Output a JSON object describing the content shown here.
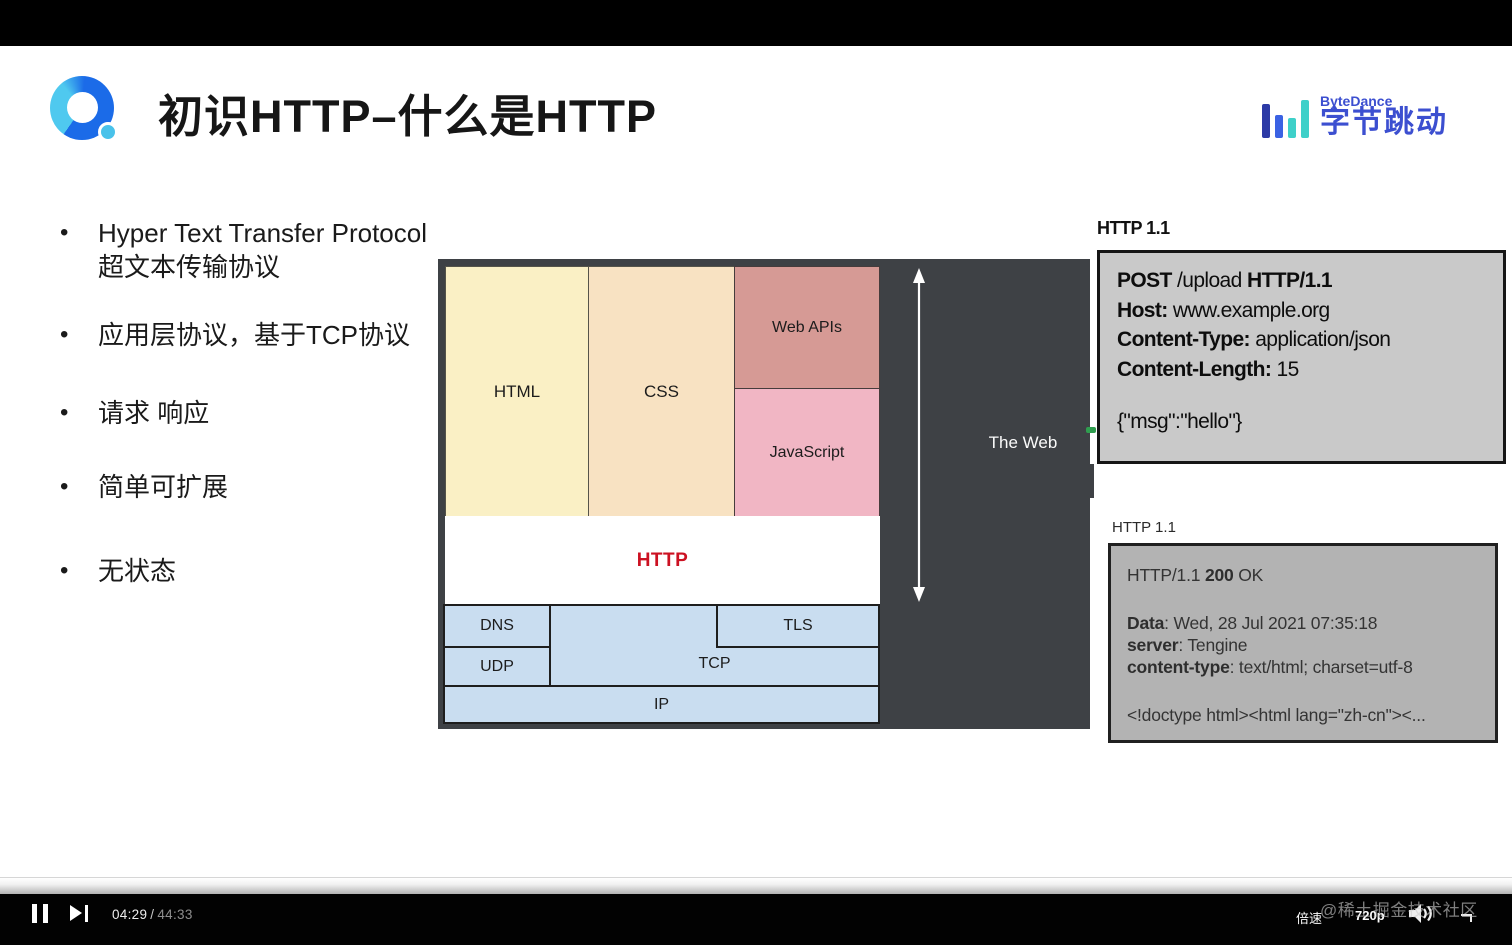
{
  "player": {
    "current_time": "04:29",
    "time_separator": "/",
    "duration": "44:33",
    "speed_label": "倍速",
    "quality_label": "720p",
    "watermark": "@稀土掘金技术社区"
  },
  "slide": {
    "title": "初识HTTP–什么是HTTP",
    "bullets": [
      {
        "line1": "Hyper Text Transfer Protocol",
        "line2": "超文本传输协议"
      },
      {
        "line1": "应用层协议，基于TCP协议"
      },
      {
        "line1": "请求 响应"
      },
      {
        "line1": "简单可扩展"
      },
      {
        "line1": "无状态"
      }
    ],
    "brand": {
      "en": "ByteDance",
      "cn": "字节跳动"
    },
    "diagram": {
      "html": "HTML",
      "css": "CSS",
      "web_apis": "Web APIs",
      "javascript": "JavaScript",
      "http": "HTTP",
      "dns": "DNS",
      "udp": "UDP",
      "tcp": "TCP",
      "tls": "TLS",
      "ip": "IP",
      "web_label": "The Web"
    },
    "http_request": {
      "label": "HTTP 1.1",
      "line1": {
        "b1": "POST",
        "t1": " /upload ",
        "b2": "HTTP/1.1"
      },
      "line2": {
        "b": "Host:",
        "t": " www.example.org"
      },
      "line3": {
        "b": "Content-Type:",
        "t": " application/json"
      },
      "line4": {
        "b": "Content-Length:",
        "t": " 15"
      },
      "body": "{\"msg\":\"hello\"}"
    },
    "http_response": {
      "label": "HTTP 1.1",
      "status": {
        "t1": "HTTP/1.1 ",
        "b": "200",
        "t2": " OK"
      },
      "header1": {
        "b": "Data",
        "t": ": Wed, 28 Jul 2021 07:35:18"
      },
      "header2": {
        "b": "server",
        "t": ": Tengine"
      },
      "header3": {
        "b": "content-type",
        "t": ": text/html; charset=utf-8"
      },
      "body": "<!doctype html><html lang=\"zh-cn\"><..."
    }
  },
  "colors": {
    "http_accent": "#CC1122",
    "diagram_frame": "#3E4145",
    "html_cell": "#FAF0C5",
    "css_cell": "#F8E2C2",
    "web_apis_cell": "#D69A95",
    "javascript_cell": "#F1B6C4",
    "network_cell": "#C9DDF0",
    "request_box": "#C9C9C9",
    "response_box": "#B3B3B3",
    "brand_blue": "#3C4FD0",
    "brand_teal": "#3ED0C9",
    "green_marker": "#2F9E4F"
  }
}
